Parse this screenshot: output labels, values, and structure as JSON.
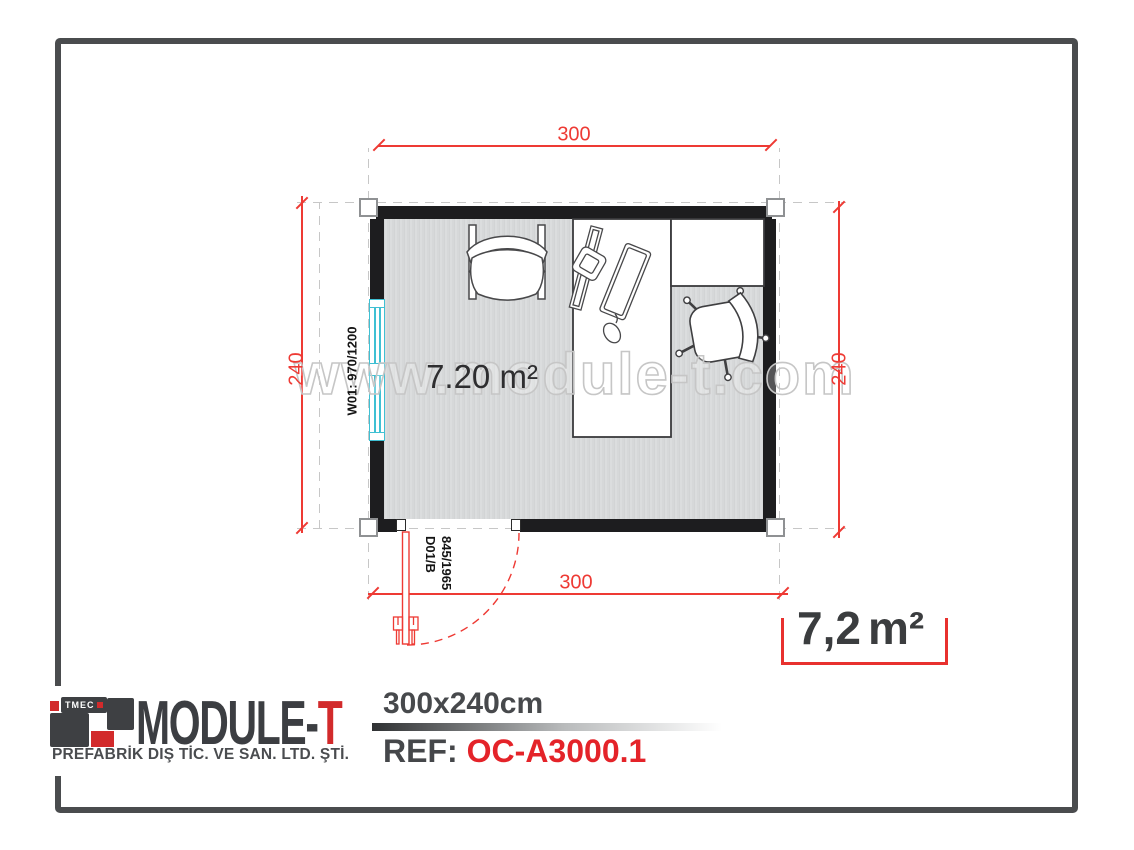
{
  "plan": {
    "dim_top": "300",
    "dim_bottom": "300",
    "dim_left": "240",
    "dim_right": "240",
    "area_label": "7.20 m²",
    "window_label": "W01: 970/1200",
    "door_label": {
      "line1": "D01/B",
      "line2": "845/1965"
    },
    "watermark": "www.module-t.com"
  },
  "area_badge": {
    "value": "7,2",
    "unit": "m²"
  },
  "footer": {
    "logo": {
      "mark_text": "TMEC",
      "name_main": "MODULE-",
      "name_accent": "T",
      "subtitle": "PREFABRİK DIŞ TİC. VE SAN. LTD. ŞTİ."
    },
    "size_label": "300x240cm",
    "ref_label": "REF:",
    "ref_value": "OC-A3000.1"
  },
  "colors": {
    "accent_red": "#ee3a34",
    "ref_red": "#e42329",
    "wall_black": "#1d1d1f",
    "window_cyan": "#3fc0d3",
    "dark_text": "#3c3e42",
    "floor_gray": "#d6d8d9"
  }
}
